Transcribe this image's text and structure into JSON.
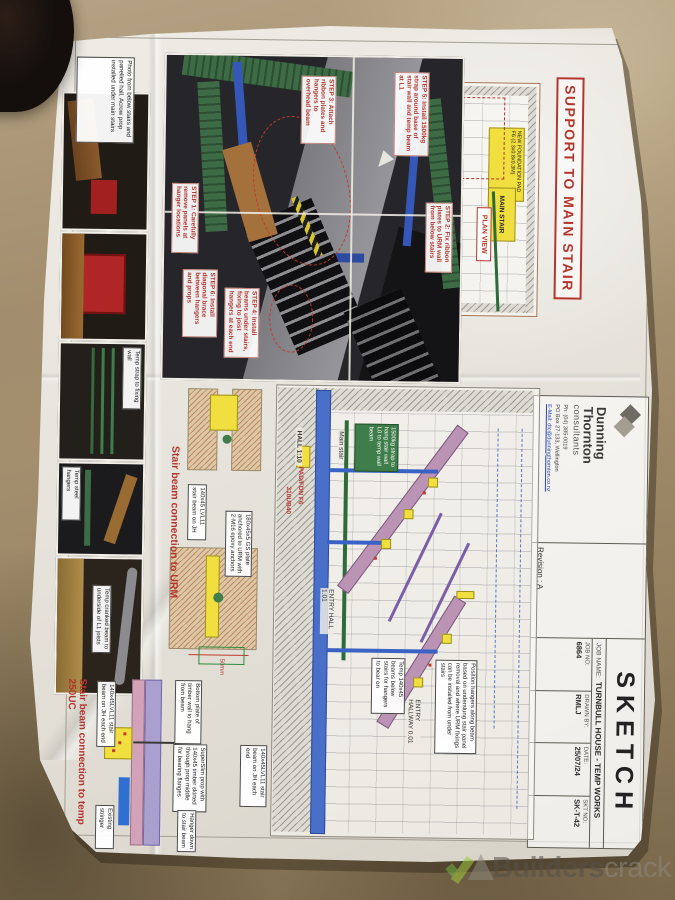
{
  "colors": {
    "accent_red": "#b3362e",
    "highlight_yellow": "#f0df3f",
    "green": "#3f7d4a",
    "blue": "#3a62c4"
  },
  "watermark": {
    "brand_bold": "Builders",
    "brand_light": "crack"
  },
  "sheet": {
    "title": "SUPPORT TO MAIN STAIR",
    "title_block": {
      "company_line1": "Dunning",
      "company_line2": "Thornton",
      "company_line3": "consultants",
      "phone": "Ph: (04) 385-0019",
      "po_box": "PO Box 27-133, Wellington",
      "email": "E-Mail: dtc@dunningthornton.co.nz",
      "revision": "Revision : A",
      "doc_type": "SKETCH",
      "job_name_label": "JOB NAME:",
      "job_name": "TURNBULL HOUSE - TEMP WORKS",
      "job_no_label": "JOB NO:",
      "job_no": "6864",
      "drawn_by_label": "DRAWN BY:",
      "drawn_by": "RMLJ",
      "date_label": "DATE:",
      "date": "25/07/24",
      "skt_label": "SKT NO:",
      "skt_no": "SK-T-42"
    },
    "plan": {
      "label": "PLAN VIEW",
      "foundation": "NEW FOUNDATION PAD F6 (2.3x0.8x0.3M)",
      "main_stair": "MAIN STAIR"
    },
    "steps": [
      "STEP 1: Carefully remove panels at hanger locations",
      "STEP 2: Fix ribbon plates to URM wall from below stairs",
      "STEP 3: Attach ribbon plates and hangers to overhead beam",
      "STEP 4: Install beams under stairs, fixing to joist hangers at each end",
      "STEP 5: Install 1500kg strap around base of stair wall and temp beam at L1",
      "STEP 6: Install diagonal brace between hangers and props"
    ],
    "captions": {
      "photo1": "Photo from below stairs and panelled hall. Acrow prop installed under main stairs",
      "photo3": "Temp strap to fixing wall",
      "photo4": "Temp steel hangers",
      "photo5": "Temp cranked beam to underside of L1 joists"
    },
    "section": {
      "hall": "HALL 1:10",
      "pad": "PAD/FDN F6",
      "ub": "310UB40",
      "main_stair": "Main stair",
      "strap": "1500kg strap to hang stair wall L0 to temp wall beam",
      "entry_hall": "ENTRY HALL 1.01",
      "entry_hallway": "ENTRY HALLWAY 0.01",
      "temp_beams": "Temp 140x45 beams below stairs for hangers to bear on",
      "position": "Position hangers along beam based on underslung stair panel removal and where URM fixings can be installed from under stairs"
    },
    "detail_urm": {
      "heading": "Stair beam connection to URM",
      "plate": "180x45x5 GS plate anchored to URM with 2-M16 epoxy anchors",
      "beam": "140x45 LVL11 stair beam on JH",
      "dim": "50mm"
    },
    "detail_uc": {
      "heading": "Stair beam connection to temp 250UC",
      "prop": "SuperSlim prop with 140x45 timber skirted through prop middle for bearing flanges",
      "beam": "140x45LVL11 stair beam on JH each end",
      "wall": "Bottom plate of timber wall to hang from beam",
      "hanger": "Hanger down to stair beam",
      "stringer": "Existing stringer"
    }
  }
}
